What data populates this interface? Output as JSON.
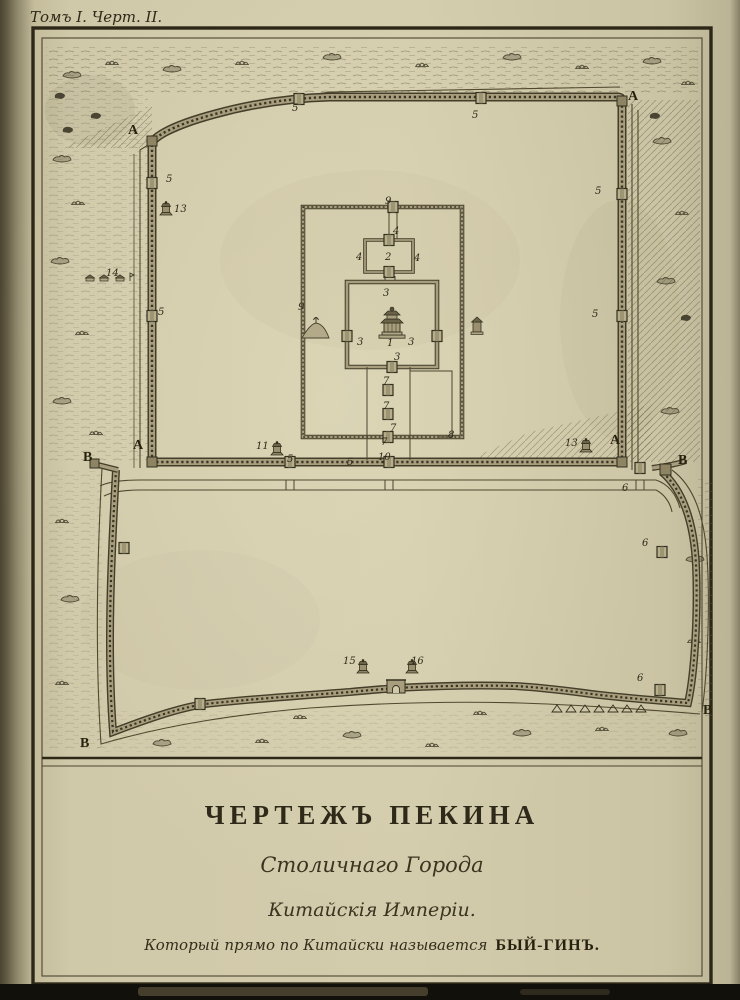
{
  "page": {
    "header": "Томъ I. Черт. II.",
    "title": {
      "line1": "ЧЕРТЕЖЪ ПЕКИНА",
      "line2": "Столичнаго Города",
      "line3": "Китайскія Имперіи.",
      "line4_script": "Который прямо по Китайски называется",
      "line4_caps": "БЫЙ-ГИНЪ."
    }
  },
  "map": {
    "description": "Engraved plan of Peking: Tatar (upper) city with Imperial and Forbidden city enclosures, Chinese (lower) city, gates numbered, corners lettered",
    "labels": [
      {
        "t": "A"
      },
      {
        "t": "A"
      },
      {
        "t": "A"
      },
      {
        "t": "A"
      },
      {
        "t": "В"
      },
      {
        "t": "В"
      },
      {
        "t": "В"
      },
      {
        "t": "В"
      },
      {
        "t": "5"
      },
      {
        "t": "5"
      },
      {
        "t": "5"
      },
      {
        "t": "13"
      },
      {
        "t": "5"
      },
      {
        "t": "14"
      },
      {
        "t": "5"
      },
      {
        "t": "5"
      },
      {
        "t": "9"
      },
      {
        "t": "4"
      },
      {
        "t": "2"
      },
      {
        "t": "4"
      },
      {
        "t": "4"
      },
      {
        "t": "3"
      },
      {
        "t": "9"
      },
      {
        "t": "1"
      },
      {
        "t": "3"
      },
      {
        "t": "3"
      },
      {
        "t": "3"
      },
      {
        "t": "7"
      },
      {
        "t": "7"
      },
      {
        "t": "7"
      },
      {
        "t": "7"
      },
      {
        "t": "8"
      },
      {
        "t": "5"
      },
      {
        "t": "10"
      },
      {
        "t": "11"
      },
      {
        "t": "5"
      },
      {
        "t": "13"
      },
      {
        "t": "6"
      },
      {
        "t": "6"
      },
      {
        "t": "6"
      },
      {
        "t": "15"
      },
      {
        "t": "16"
      }
    ]
  },
  "colors": {
    "paper": "#d0c9a9",
    "ink": "#33301f",
    "wall_mid": "#a89e7d",
    "wall_dark": "#433d2a",
    "hatch": "#6b6348"
  }
}
